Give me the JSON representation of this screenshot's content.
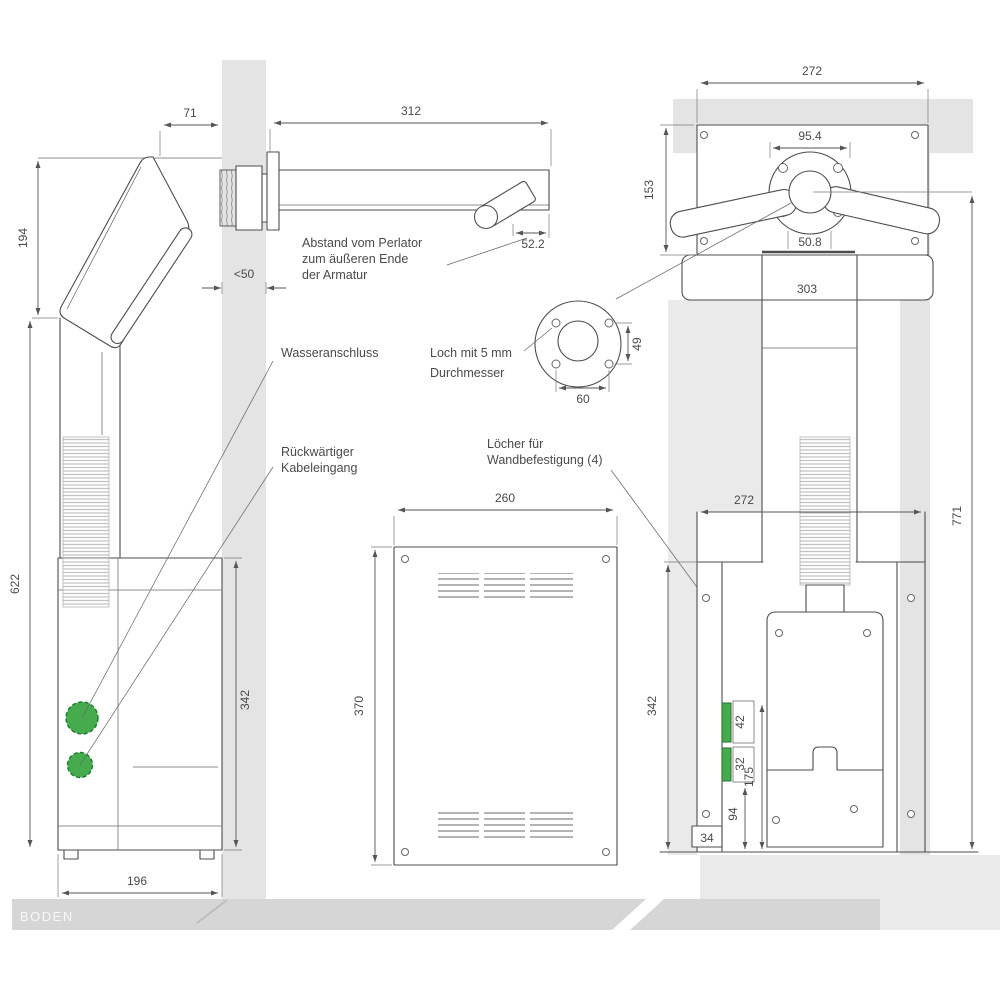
{
  "views": {
    "side": {
      "dims": {
        "wall_offset": "71",
        "spout_length": "312",
        "head_height": "194",
        "wall_thickness": "<50",
        "perlator_end_offset": "52.2",
        "body_height": "622",
        "lower_body_height": "342",
        "base_width": "196"
      },
      "notes": {
        "water": "Wasseranschluss",
        "cable1": "Rückwärtiger",
        "cable2": "Kabeleingang",
        "perlator1": "Abstand vom Perlator",
        "perlator2": "zum äußeren Ende",
        "perlator3": "der Armatur"
      }
    },
    "plan": {
      "dims": {
        "plate_width": "272",
        "plate_depth": "153",
        "hub_width": "95.4",
        "hub_base_width": "50.8",
        "overall_width": "303"
      }
    },
    "hole_detail": {
      "dims": {
        "width": "60",
        "height": "49"
      },
      "notes": {
        "line1": "Loch mit 5 mm",
        "line2": "Durchmesser"
      }
    },
    "front": {
      "dims": {
        "width": "260",
        "height": "370"
      },
      "notes": {
        "wand1": "Löcher für",
        "wand2": "Wandbefestigung (4)"
      }
    },
    "back": {
      "dims": {
        "niche_width": "272",
        "overall_height": "771",
        "panel_height": "342",
        "connector_a": "42",
        "connector_b": "32",
        "connector_offset": "94",
        "base_height": "34",
        "inner_span": "175"
      }
    }
  },
  "environment": {
    "floor_label": "BODEN"
  },
  "colors": {
    "accent_green": "#46AB4C",
    "wall": "#E4E4E4",
    "wall_light": "#EAEAEA",
    "floor": "#D6D6D6",
    "line": "#4D4D4D"
  }
}
